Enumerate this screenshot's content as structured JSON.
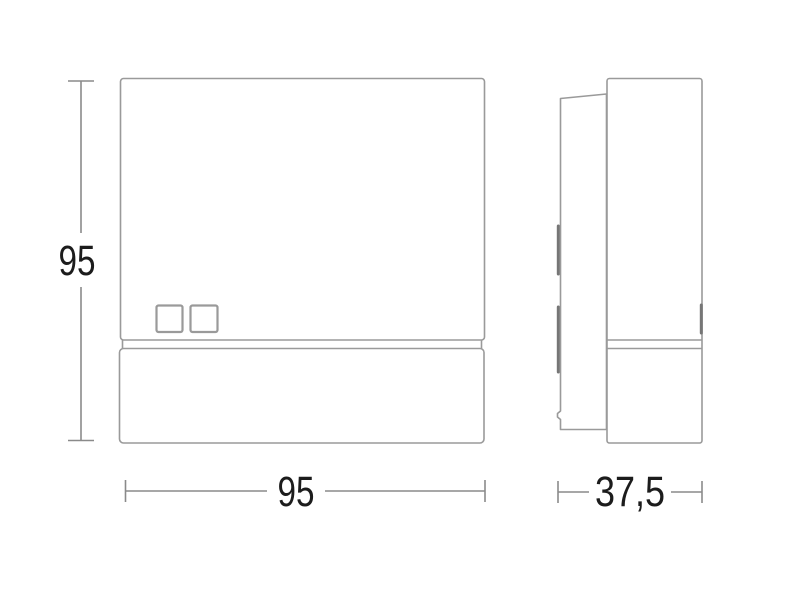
{
  "diagram": {
    "front_view": {
      "height_dimension_label": "95",
      "width_dimension_label": "95"
    },
    "side_view": {
      "depth_dimension_label": "37,5"
    },
    "colors": {
      "background": "#ffffff",
      "outline": "#9a9a9a",
      "detail": "#767676",
      "dimension_line": "#8a8a8a",
      "label_text": "#1c1c1c"
    }
  }
}
